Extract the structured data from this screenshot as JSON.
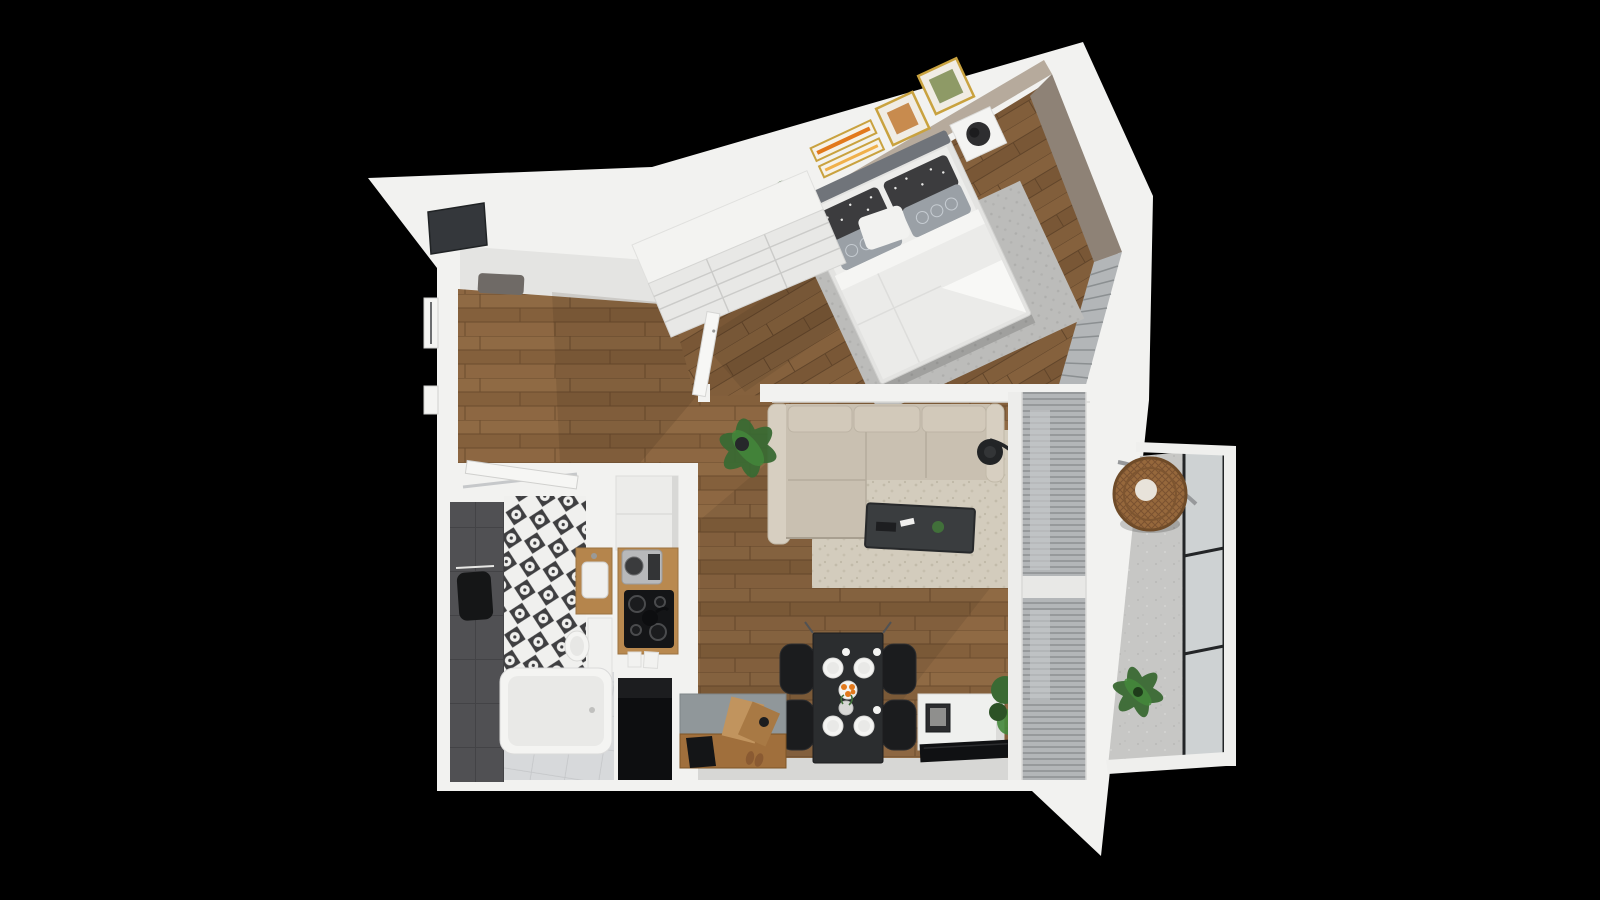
{
  "meta": {
    "description": "3D top-down architectural rendering of a one-bedroom apartment floor plan on a black background",
    "canvas": {
      "width": 1600,
      "height": 900
    }
  },
  "palette": {
    "background": "#000000",
    "wall": "#f2f2f0",
    "wall_shade": "#e4e4e2",
    "wood_floor": "#8a6540",
    "wood_floor_dark": "#6b4c2e",
    "wood_floor_bedroom": "#7f5c39",
    "accent_wall": "#b6aa9c",
    "accent_wall_dark": "#8e8276",
    "dark_tile": "#505053",
    "pattern_tile_ink": "#3f3f41",
    "bath_floor": "#d7d9db",
    "rug_living": "#d3ccbd",
    "rug_bedroom": "#bcbcba",
    "sofa_fabric": "#c9c0b1",
    "sofa_arm": "#d7cfc1",
    "coffee_table": "#3a3d3f",
    "dining_black": "#1b1c1e",
    "counter_wood": "#b9894f",
    "cooktop_black": "#141517",
    "balcony_floor": "#c7c7c5",
    "railing_frame": "#232527",
    "wicker_chair": "#96683c",
    "plant_green": "#3a6a33",
    "plant_green_light": "#44883b",
    "frame_gold": "#c9a23f",
    "art_orange": "#e2791c",
    "blinds_gray": "#b3b6b8",
    "duvet_white": "#ebebe9",
    "headboard_gray": "#70747a",
    "shadow_tint": "#2b1d10"
  },
  "rooms": [
    {
      "name": "bedroom",
      "furniture": [
        "double bed",
        "polka-dot and patterned pillows",
        "gray area rug",
        "two white nightstands",
        "black sphere table lamp",
        "potted plant",
        "sliding-door wardrobe",
        "four gold wall art frames",
        "window blinds"
      ]
    },
    {
      "name": "living-room",
      "furniture": [
        "L-shaped beige sofa",
        "beige area rug",
        "dark coffee table",
        "arc floor lamp",
        "potted plant",
        "black dining table with four chairs",
        "white plates with orange flowers",
        "wood sideboard bench",
        "white TV cabinet with television",
        "full-height window blinds"
      ]
    },
    {
      "name": "kitchen",
      "furniture": [
        "white upper cabinets",
        "coffee machine",
        "wooden counter",
        "black cooktop with four burners",
        "kettle",
        "cutting boards",
        "dark appliance niche"
      ]
    },
    {
      "name": "bathroom",
      "furniture": [
        "dark tile wall",
        "moroccan patterned tile wall",
        "black towel",
        "shower rail",
        "wood vanity with white sink",
        "wall-hung toilet",
        "bathtub",
        "light tile floor",
        "open door"
      ]
    },
    {
      "name": "hallway",
      "furniture": [
        "suspended ceiling panel",
        "entrance mirror",
        "door frames",
        "bench"
      ]
    },
    {
      "name": "balcony",
      "furniture": [
        "hanging wicker chair",
        "potted plant",
        "black-framed glass railing",
        "concrete floor"
      ]
    }
  ]
}
